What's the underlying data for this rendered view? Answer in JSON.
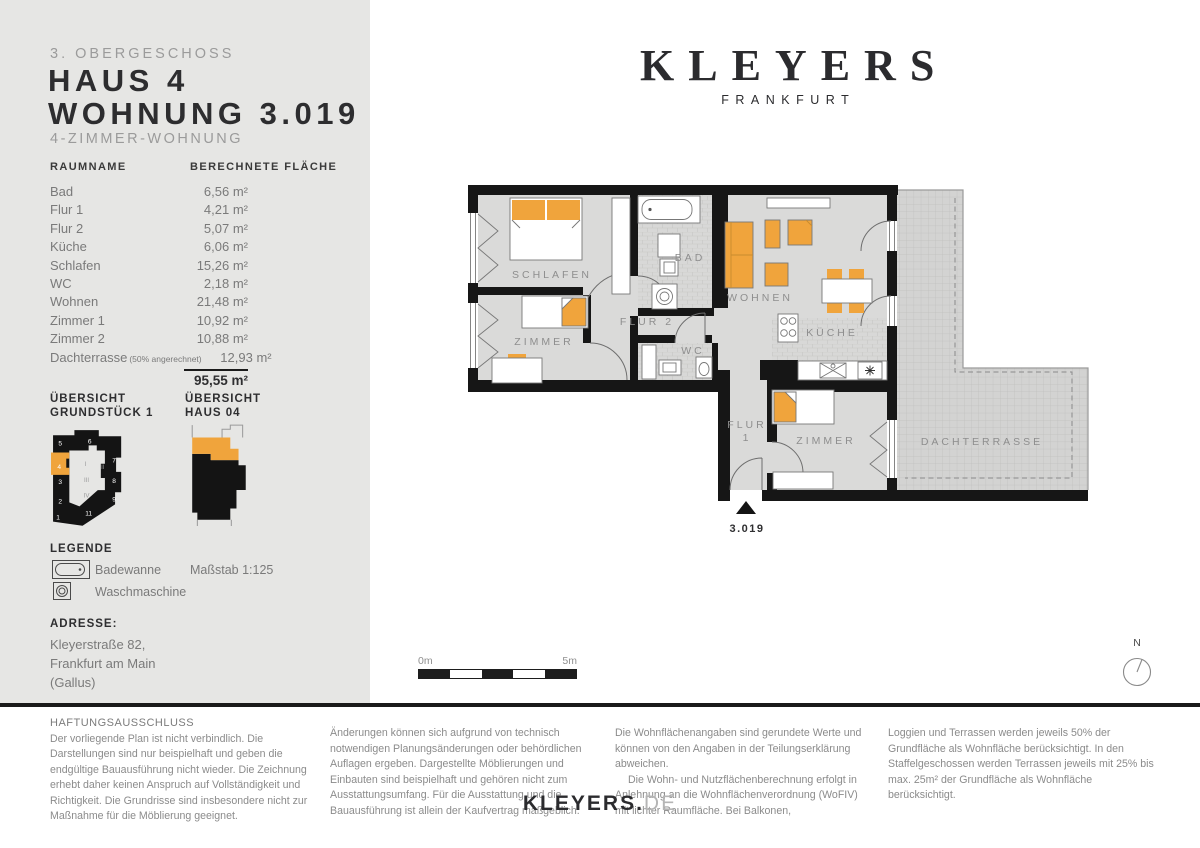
{
  "colors": {
    "accent": "#F0A43C",
    "wall": "#161616",
    "panel_bg": "#E6E6E4",
    "room_gray": "#DADAD9"
  },
  "panel": {
    "floor_label": "3. OBERGESCHOSS",
    "title_line1": "HAUS 4",
    "title_line2": "WOHNUNG 3.019",
    "subtitle": "4-ZIMMER-WOHNUNG",
    "table": {
      "col_room": "RAUMNAME",
      "col_area": "BERECHNETE FLÄCHE",
      "rows": [
        {
          "name": "Bad",
          "value": "6,56 m²"
        },
        {
          "name": "Flur 1",
          "value": "4,21 m²"
        },
        {
          "name": "Flur 2",
          "value": "5,07 m²"
        },
        {
          "name": "Küche",
          "value": "6,06 m²"
        },
        {
          "name": "Schlafen",
          "value": "15,26 m²"
        },
        {
          "name": "WC",
          "value": "2,18 m²"
        },
        {
          "name": "Wohnen",
          "value": "21,48 m²"
        },
        {
          "name": "Zimmer 1",
          "value": "10,92 m²"
        },
        {
          "name": "Zimmer 2",
          "value": "10,88 m²"
        },
        {
          "name": "Dachterrasse",
          "note": "(50% angerechnet)",
          "value": "12,93 m²"
        }
      ],
      "total_value": "95,55 m²"
    },
    "overview_left_line1": "ÜBERSICHT",
    "overview_left_line2": "GRUNDSTÜCK 1",
    "overview_right_line1": "ÜBERSICHT",
    "overview_right_line2": "HAUS 04",
    "site_numbers": {
      "n5": "5",
      "n6": "6",
      "n7": "7",
      "n8": "8",
      "n9": "9",
      "n4": "4",
      "n3": "3",
      "n2": "2",
      "n1": "1",
      "n11": "11"
    },
    "site_romans": {
      "r1": "I",
      "r2": "II",
      "r3": "III",
      "r4": "IV"
    },
    "legend": {
      "heading": "LEGENDE",
      "item1": "Badewanne",
      "item2": "Waschmaschine",
      "scale": "Maßstab 1:125"
    },
    "address": {
      "heading": "ADRESSE:",
      "line1": "Kleyerstraße 82,",
      "line2": "Frankfurt am Main",
      "line3": "(Gallus)"
    }
  },
  "brand": {
    "logo": "KLEYERS",
    "city": "FRANKFURT"
  },
  "plan": {
    "rooms": {
      "schlafen": "SCHLAFEN",
      "zimmer_left": "ZIMMER",
      "bad": "BAD",
      "flur2": "FLUR 2",
      "wc": "WC",
      "wohnen": "WOHNEN",
      "kueche": "KÜCHE",
      "flur1_l1": "FLUR",
      "flur1_l2": "1",
      "zimmer_bottom": "ZIMMER",
      "dachterrasse": "DACHTERRASSE"
    },
    "unit_label": "3.019",
    "scale_bar": {
      "start": "0m",
      "end": "5m"
    },
    "north_label": "N"
  },
  "disclaimer": {
    "heading": "HAFTUNGSAUSSCHLUSS",
    "col1": "Der vorliegende Plan ist nicht verbindlich. Die Darstellungen sind nur beispielhaft und geben die endgültige Bauausführung nicht wieder. Die Zeichnung erhebt daher keinen Anspruch auf Vollständigkeit und Richtigkeit. Die Grundrisse sind insbesondere nicht zur Maßnahme für die Möblierung geeignet.",
    "col2": "Änderungen können sich aufgrund von technisch notwendigen Planungsänderungen oder behördlichen Auflagen ergeben. Dargestellte Möblierungen und Einbauten sind beispielhaft und gehören nicht zum Ausstattungsumfang. Für die Ausstattung und die Bauausführung ist allein der Kaufvertrag maßgeblich.",
    "col3_p1": "Die Wohnflächenangaben sind gerundete Werte und können von den Angaben in der Teilungserklärung abweichen.",
    "col3_p2": "Die Wohn- und Nutzflächenberechnung erfolgt in Anlehnung an die Wohnflächenverordnung (WoFIV) mit lichter Raumfläche. Bei Balkonen,",
    "col4": "Loggien und Terrassen werden jeweils 50% der Grundfläche als Wohnfläche berücksichtigt. In den Staffelgeschossen werden Terrassen jeweils mit 25% bis max. 25m² der Grundfläche als Wohnfläche berücksichtigt."
  },
  "footer": {
    "site_bold": "KLEYERS.",
    "site_gray": "DE"
  }
}
